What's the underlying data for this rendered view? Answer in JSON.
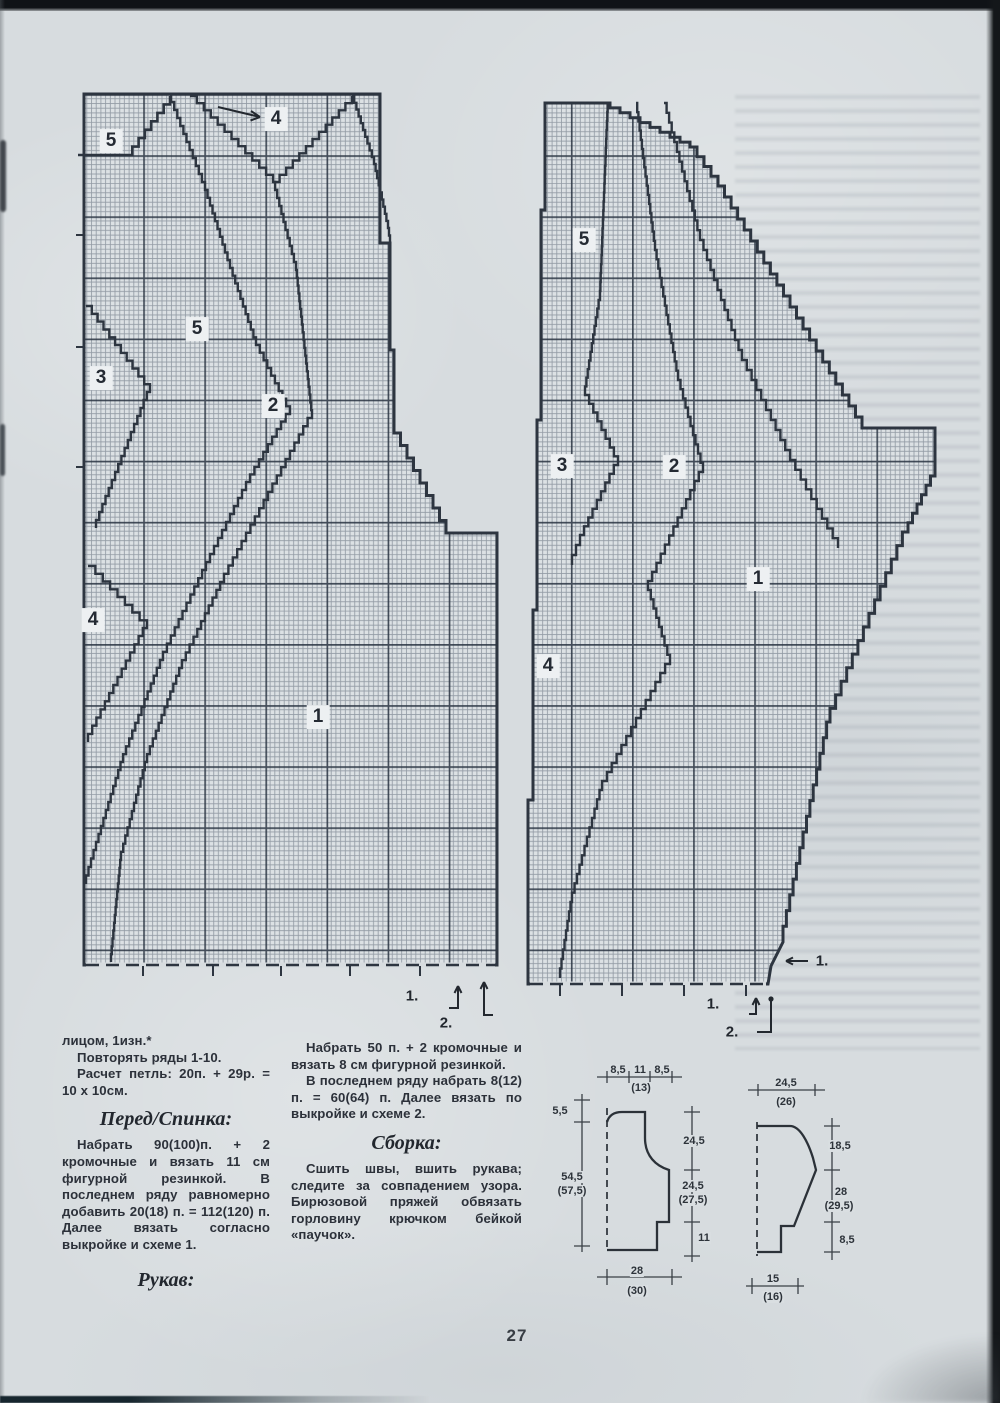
{
  "page": {
    "number": "27"
  },
  "charts": {
    "chart1": {
      "region_labels": [
        {
          "text": "5",
          "x": 111,
          "y": 141
        },
        {
          "text": "4",
          "x": 276,
          "y": 119
        },
        {
          "text": "5",
          "x": 197,
          "y": 329
        },
        {
          "text": "3",
          "x": 101,
          "y": 378
        },
        {
          "text": "2",
          "x": 273,
          "y": 406
        },
        {
          "text": "4",
          "x": 93,
          "y": 620
        },
        {
          "text": "1",
          "x": 318,
          "y": 717
        }
      ],
      "bottom_labels": [
        {
          "text": "1.",
          "x": 412,
          "y": 996
        },
        {
          "text": "2.",
          "x": 446,
          "y": 1023
        }
      ]
    },
    "chart2": {
      "region_labels": [
        {
          "text": "5",
          "x": 584,
          "y": 240
        },
        {
          "text": "3",
          "x": 562,
          "y": 466
        },
        {
          "text": "2",
          "x": 674,
          "y": 467
        },
        {
          "text": "1",
          "x": 758,
          "y": 579
        },
        {
          "text": "4",
          "x": 548,
          "y": 666
        }
      ],
      "bottom_labels": [
        {
          "text": "1.",
          "x": 713,
          "y": 1004
        },
        {
          "text": "2.",
          "x": 732,
          "y": 1032
        }
      ],
      "side_label": [
        {
          "text": "1.",
          "x": 822,
          "y": 961
        }
      ]
    }
  },
  "instructions": {
    "left_column": {
      "p1": "лицом, 1изн.*",
      "p2": "Повторять ряды 1-10.",
      "p3": "Расчет петль: 20п. + 29р. = 10 х 10см.",
      "h1": "Перед/Спинка:",
      "p4": "Набрать 90(100)п. + 2 кромочные и вязать 11 см фигурной резинкой. В последнем ряду равномерно добавить 20(18) п. = 112(120) п. Далее вязать согласно выкройке и схеме 1.",
      "h2": "Рукав:"
    },
    "middle_column": {
      "p1": "Набрать 50 п. + 2 кромочные и вязать 8 см фигурной резинкой.",
      "p2": "В последнем ряду набрать 8(12) п. = 60(64) п. Далее вязать по выкройке и схеме 2.",
      "h1": "Сборка:",
      "p3": "Сшить швы, вшить рукава; следите за совпадением узора. Бирюзовой пряжей обвязать горловину крючком бейкой «паучок»."
    }
  },
  "schematics": {
    "body": {
      "labels": [
        {
          "text": "8,5",
          "x": 618,
          "y": 1070
        },
        {
          "text": "11",
          "x": 640,
          "y": 1070
        },
        {
          "text": "8,5",
          "x": 662,
          "y": 1070
        },
        {
          "text": "(13)",
          "x": 641,
          "y": 1088
        },
        {
          "text": "5,5",
          "x": 560,
          "y": 1111
        },
        {
          "text": "54,5",
          "x": 572,
          "y": 1177
        },
        {
          "text": "(57,5)",
          "x": 572,
          "y": 1191
        },
        {
          "text": "24,5",
          "x": 694,
          "y": 1141
        },
        {
          "text": "24,5",
          "x": 693,
          "y": 1186
        },
        {
          "text": "(27,5)",
          "x": 693,
          "y": 1200
        },
        {
          "text": "11",
          "x": 704,
          "y": 1238
        },
        {
          "text": "28",
          "x": 637,
          "y": 1271
        },
        {
          "text": "(30)",
          "x": 637,
          "y": 1291
        }
      ]
    },
    "sleeve": {
      "labels": [
        {
          "text": "24,5",
          "x": 786,
          "y": 1083
        },
        {
          "text": "(26)",
          "x": 786,
          "y": 1102
        },
        {
          "text": "18,5",
          "x": 840,
          "y": 1146
        },
        {
          "text": "28",
          "x": 841,
          "y": 1192
        },
        {
          "text": "(29,5)",
          "x": 839,
          "y": 1206
        },
        {
          "text": "8,5",
          "x": 847,
          "y": 1240
        },
        {
          "text": "15",
          "x": 773,
          "y": 1279
        },
        {
          "text": "(16)",
          "x": 773,
          "y": 1297
        }
      ]
    }
  }
}
